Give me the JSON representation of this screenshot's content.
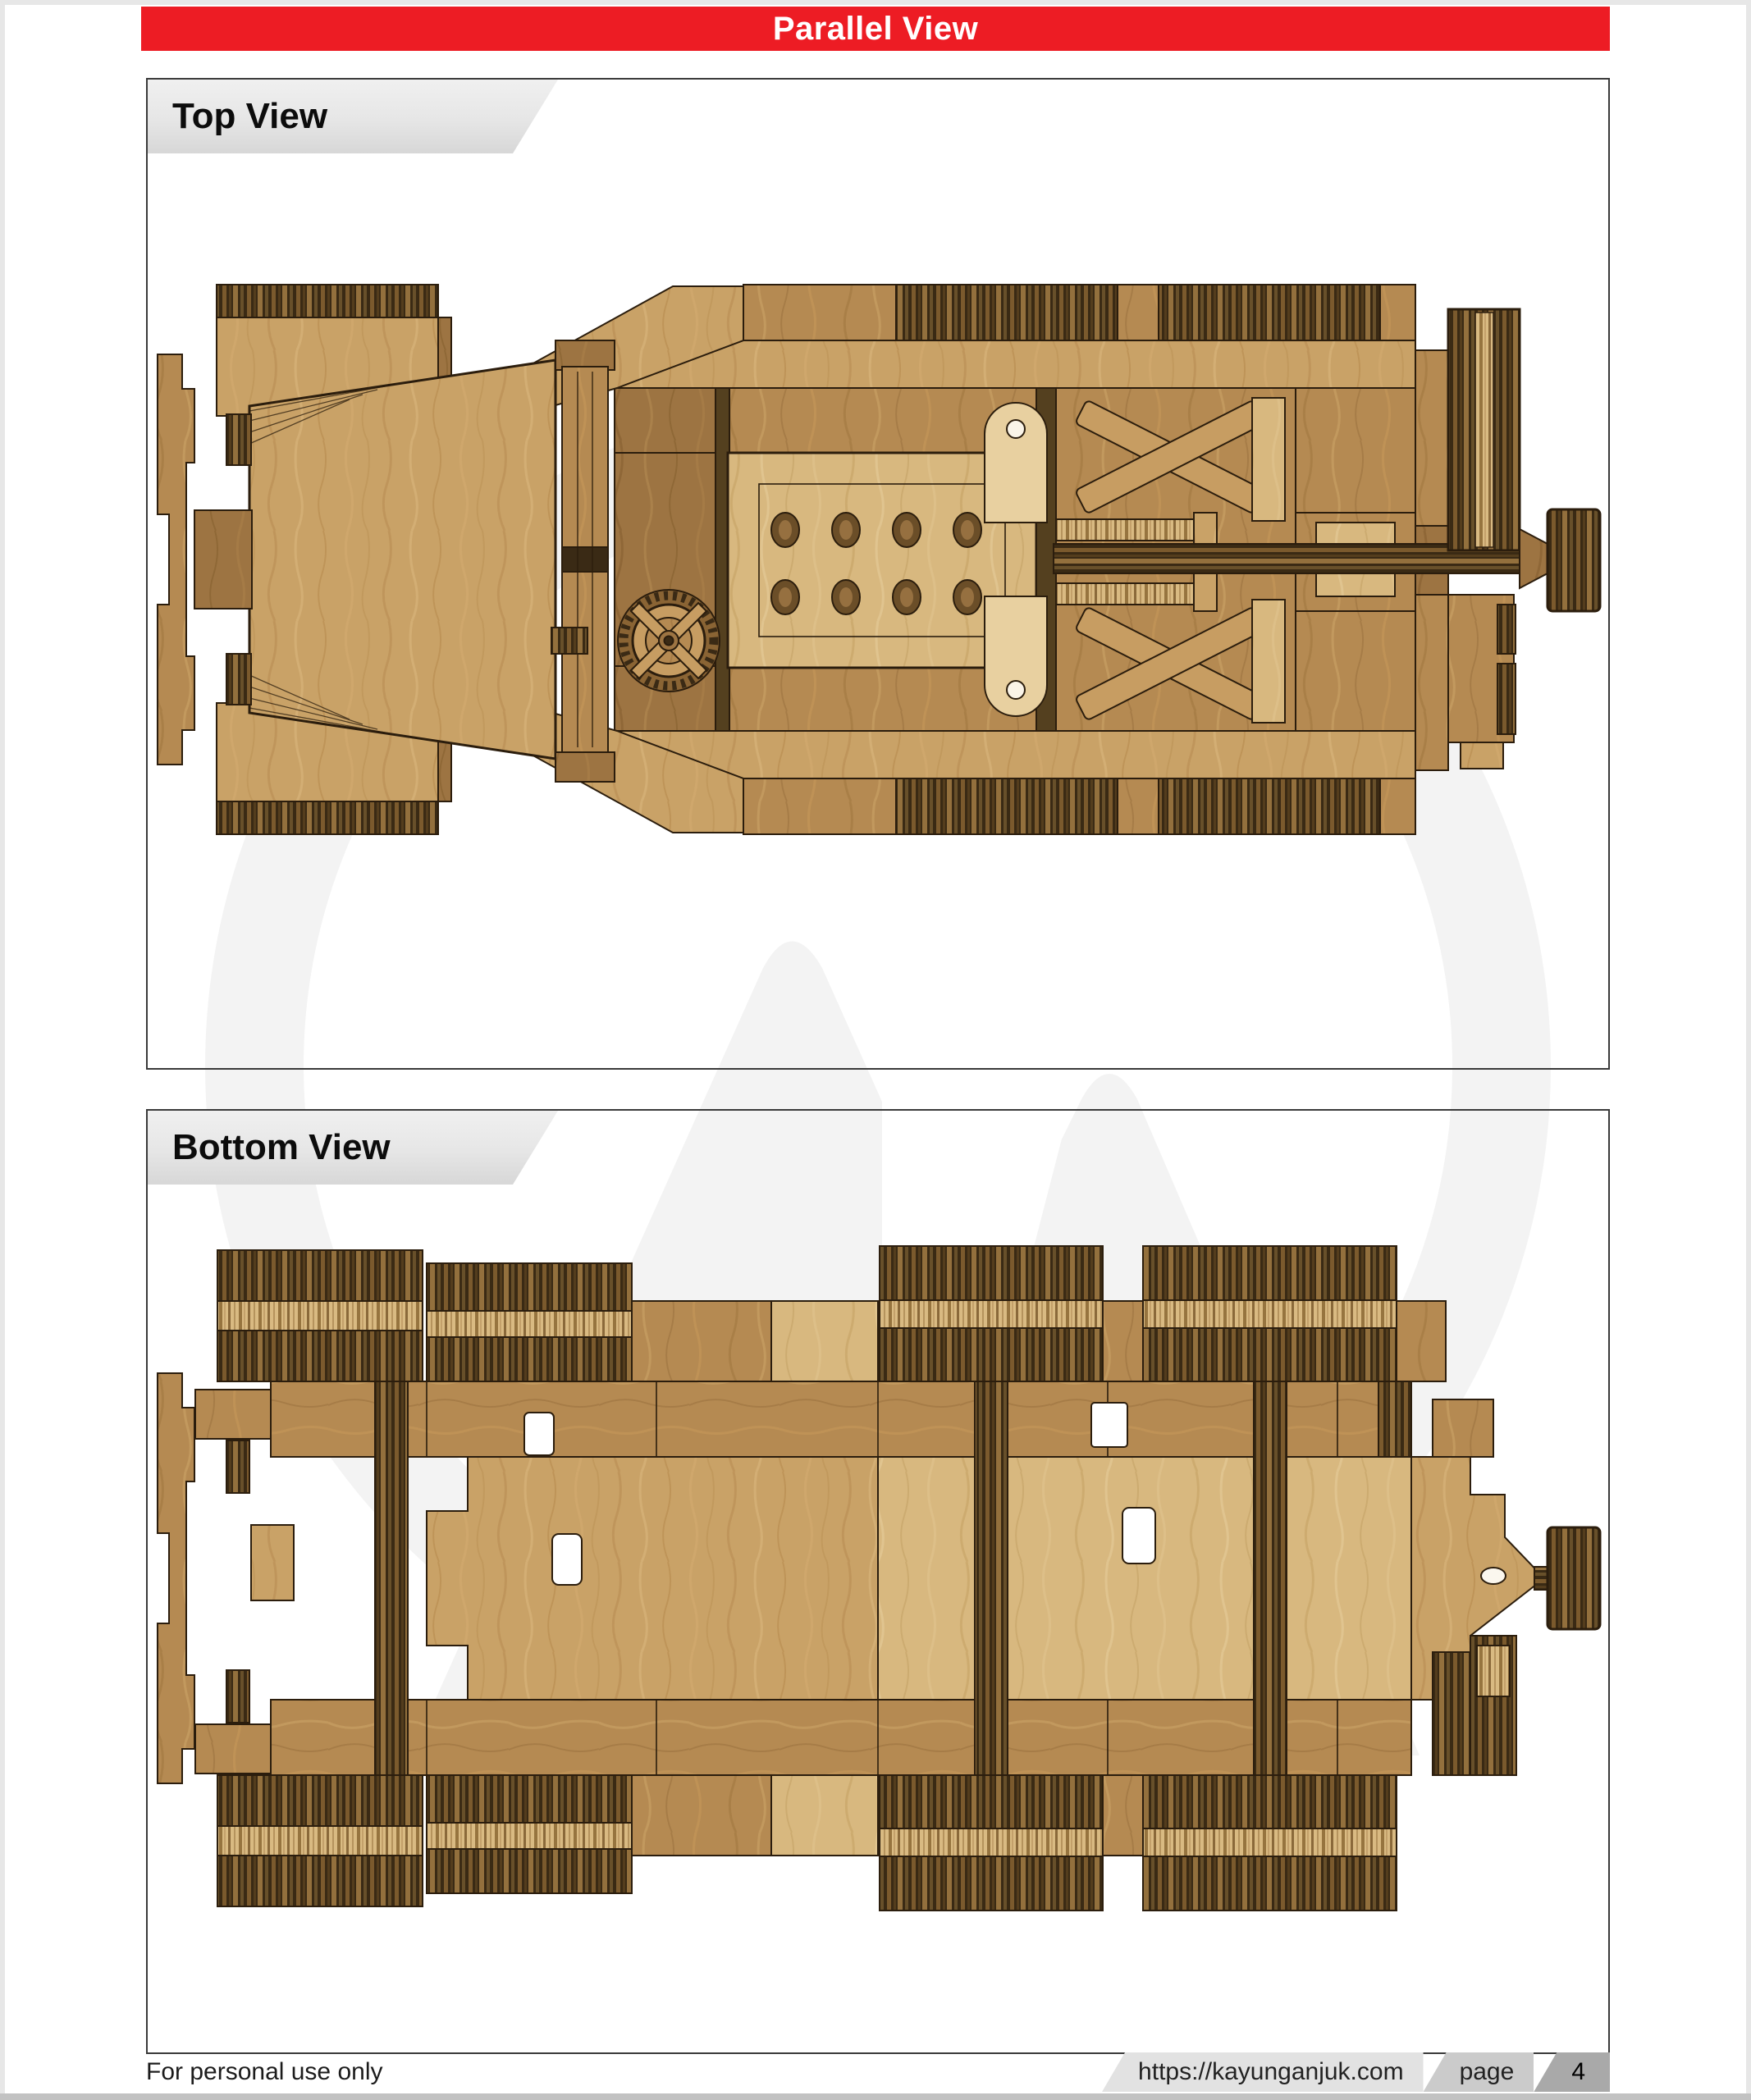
{
  "header": {
    "title": "Parallel View"
  },
  "panels": [
    {
      "id": "top-view",
      "label": "Top View",
      "illustration": "wooden-model-half-track-top-view"
    },
    {
      "id": "bottom-view",
      "label": "Bottom View",
      "illustration": "wooden-model-half-track-bottom-view"
    }
  ],
  "footer": {
    "usage_note": "For personal use only",
    "site_url": "https://kayunganjuk.com",
    "page_label": "page",
    "page_number": "4"
  },
  "colors": {
    "accent_red": "#ed1c24",
    "banner_text": "#ffffff",
    "label_bar_gray": "#e9e9e9",
    "panel_border": "#3a3a3a",
    "watermark_gray": "#f3f3f3",
    "wood_light": "#c9a267",
    "wood_medium": "#b58a52",
    "wood_dark": "#9d7442",
    "wood_pale": "#d8b87f",
    "tread_dark": "#3a2a14",
    "outline_brown": "#2b1d0d",
    "footer_url_bg": "#e2e2e2",
    "footer_page_bg": "#cbcbcb",
    "footer_number_bg": "#a9a9a9"
  }
}
